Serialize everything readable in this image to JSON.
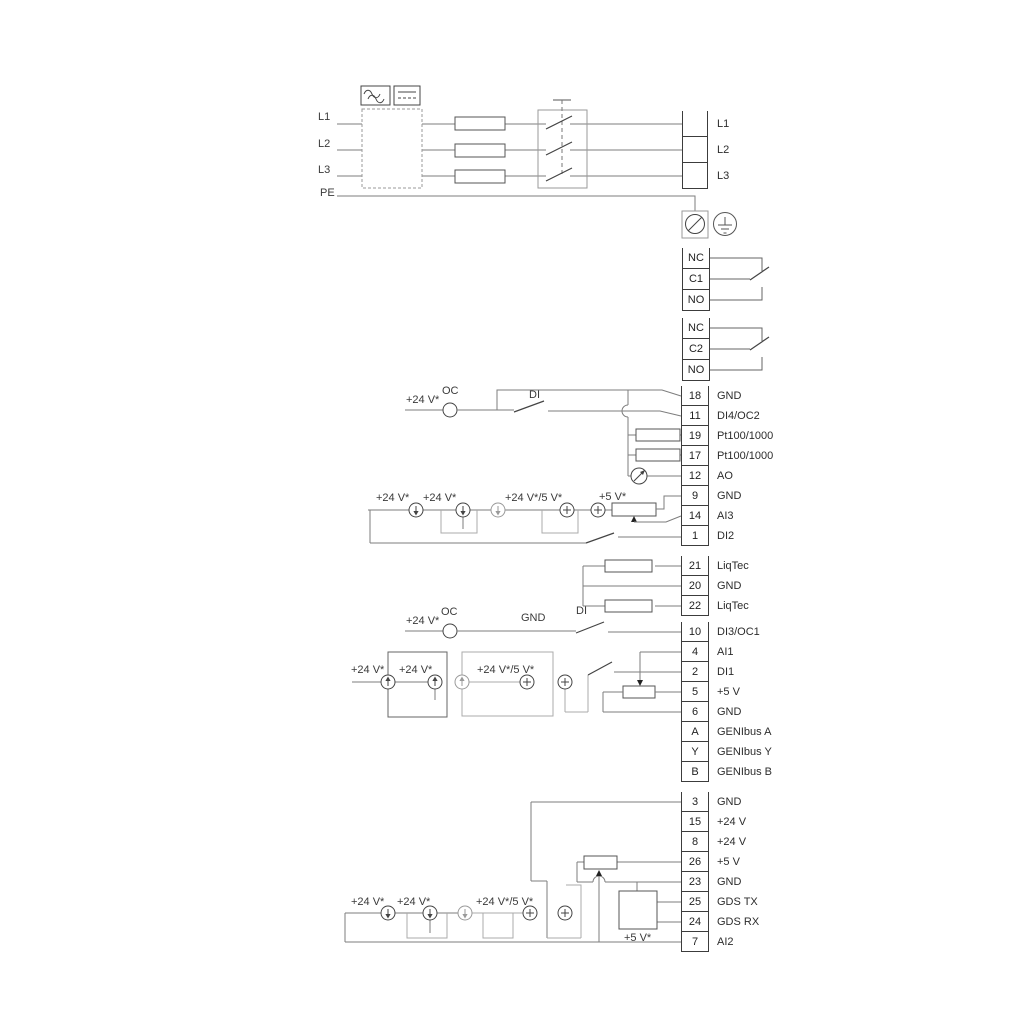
{
  "texts": {
    "v24": "+24 V*",
    "v24_5v": "+24 V*/5 V*",
    "v5": "+5 V*",
    "oc": "OC",
    "di": "DI",
    "gnd": "GND"
  },
  "power": {
    "inputs": [
      "L1",
      "L2",
      "L3",
      "PE"
    ],
    "terminals": [
      {
        "label": "L1"
      },
      {
        "label": "L2"
      },
      {
        "label": "L3"
      }
    ]
  },
  "relays": {
    "relay1": [
      {
        "label": "NC"
      },
      {
        "label": "C1"
      },
      {
        "label": "NO"
      }
    ],
    "relay2": [
      {
        "label": "NC"
      },
      {
        "label": "C2"
      },
      {
        "label": "NO"
      }
    ]
  },
  "terminal_groups": {
    "io1": [
      {
        "num": "18",
        "label": "GND"
      },
      {
        "num": "11",
        "label": "DI4/OC2"
      },
      {
        "num": "19",
        "label": "Pt100/1000"
      },
      {
        "num": "17",
        "label": "Pt100/1000"
      },
      {
        "num": "12",
        "label": "AO"
      },
      {
        "num": "9",
        "label": "GND"
      },
      {
        "num": "14",
        "label": "AI3"
      },
      {
        "num": "1",
        "label": "DI2"
      }
    ],
    "liqtec": [
      {
        "num": "21",
        "label": "LiqTec"
      },
      {
        "num": "20",
        "label": "GND"
      },
      {
        "num": "22",
        "label": "LiqTec"
      }
    ],
    "io2": [
      {
        "num": "10",
        "label": "DI3/OC1"
      },
      {
        "num": "4",
        "label": "AI1"
      },
      {
        "num": "2",
        "label": "DI1"
      },
      {
        "num": "5",
        "label": "+5 V"
      },
      {
        "num": "6",
        "label": "GND"
      },
      {
        "num": "A",
        "label": "GENIbus A"
      },
      {
        "num": "Y",
        "label": "GENIbus Y"
      },
      {
        "num": "B",
        "label": "GENIbus B"
      }
    ],
    "io3": [
      {
        "num": "3",
        "label": "GND"
      },
      {
        "num": "15",
        "label": "+24 V"
      },
      {
        "num": "8",
        "label": "+24 V"
      },
      {
        "num": "26",
        "label": "+5 V"
      },
      {
        "num": "23",
        "label": "GND"
      },
      {
        "num": "25",
        "label": "GDS TX"
      },
      {
        "num": "24",
        "label": "GDS RX"
      },
      {
        "num": "7",
        "label": "AI2"
      }
    ]
  }
}
